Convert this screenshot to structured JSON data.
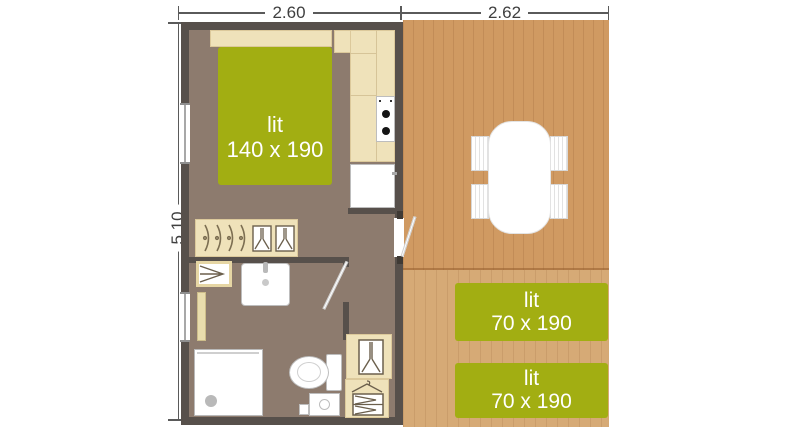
{
  "dimensions": {
    "width_left_m": "2.60",
    "width_right_m": "2.62",
    "height_m": "5.10"
  },
  "beds": {
    "double": {
      "label": "lit",
      "size": "140 x 190"
    },
    "single_top": {
      "label": "lit",
      "size": "70 x 190"
    },
    "single_bottom": {
      "label": "lit",
      "size": "70 x 190"
    }
  },
  "colors": {
    "bed_green": "#a2ae12",
    "deck_wood": "#d09a62",
    "deck_wood_light": "#d6aa76",
    "floor": "#8d7b6e",
    "wall": "#57504b",
    "furniture_cream": "#efe2ba",
    "dimension_text": "#3f3f3f"
  }
}
